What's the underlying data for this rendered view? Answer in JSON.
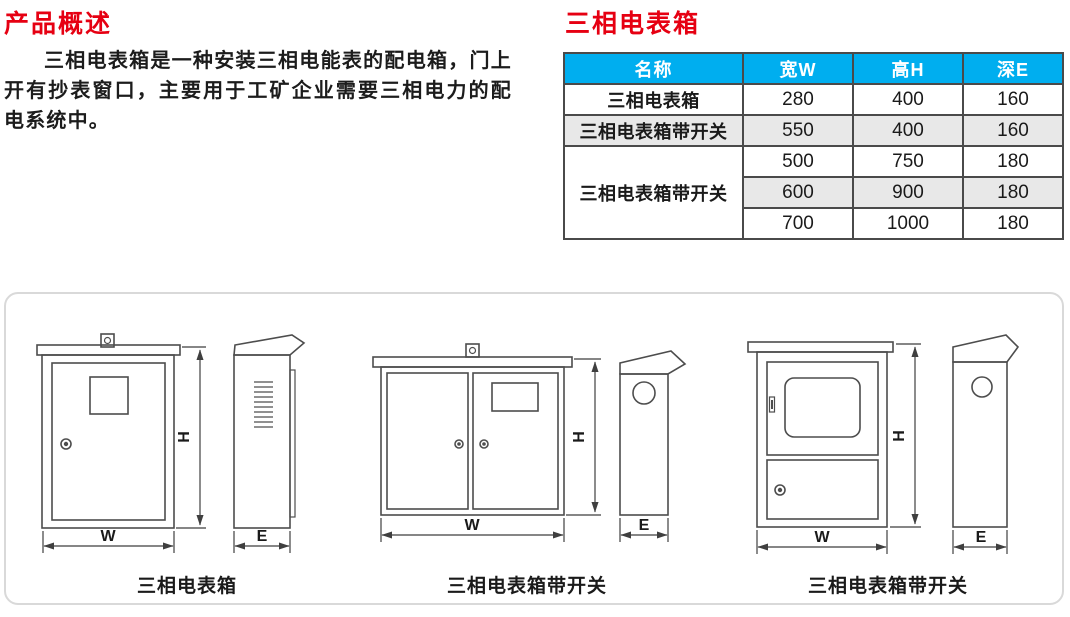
{
  "overview": {
    "title": "产品概述",
    "body": "三相电表箱是一种安装三相电能表的配电箱，门上开有抄表窗口，主要用于工矿企业需要三相电力的配电系统中。"
  },
  "spec": {
    "title": "三相电表箱",
    "table": {
      "headers": [
        "名称",
        "宽W",
        "高H",
        "深E"
      ],
      "rows": [
        {
          "name": "三相电表箱",
          "w": "280",
          "h": "400",
          "e": "160"
        },
        {
          "name": "三相电表箱带开关",
          "w": "550",
          "h": "400",
          "e": "160"
        },
        {
          "name": "三相电表箱带开关",
          "w": "500",
          "h": "750",
          "e": "180"
        },
        {
          "w": "600",
          "h": "900",
          "e": "180"
        },
        {
          "w": "700",
          "h": "1000",
          "e": "180"
        }
      ]
    }
  },
  "diagrams": {
    "dimension_labels": {
      "width": "W",
      "height": "H",
      "depth": "E"
    },
    "figures": [
      {
        "caption": "三相电表箱"
      },
      {
        "caption": "三相电表箱带开关"
      },
      {
        "caption": "三相电表箱带开关"
      }
    ]
  },
  "colors": {
    "accent_red": "#e60012",
    "table_header_bg": "#00aeef",
    "table_header_text": "#ffffff",
    "row_alt_gray": "#e8e8e8",
    "table_border": "#4a4a4a",
    "drawing_line": "#4d4d4d",
    "panel_border": "#d9d9d9"
  }
}
